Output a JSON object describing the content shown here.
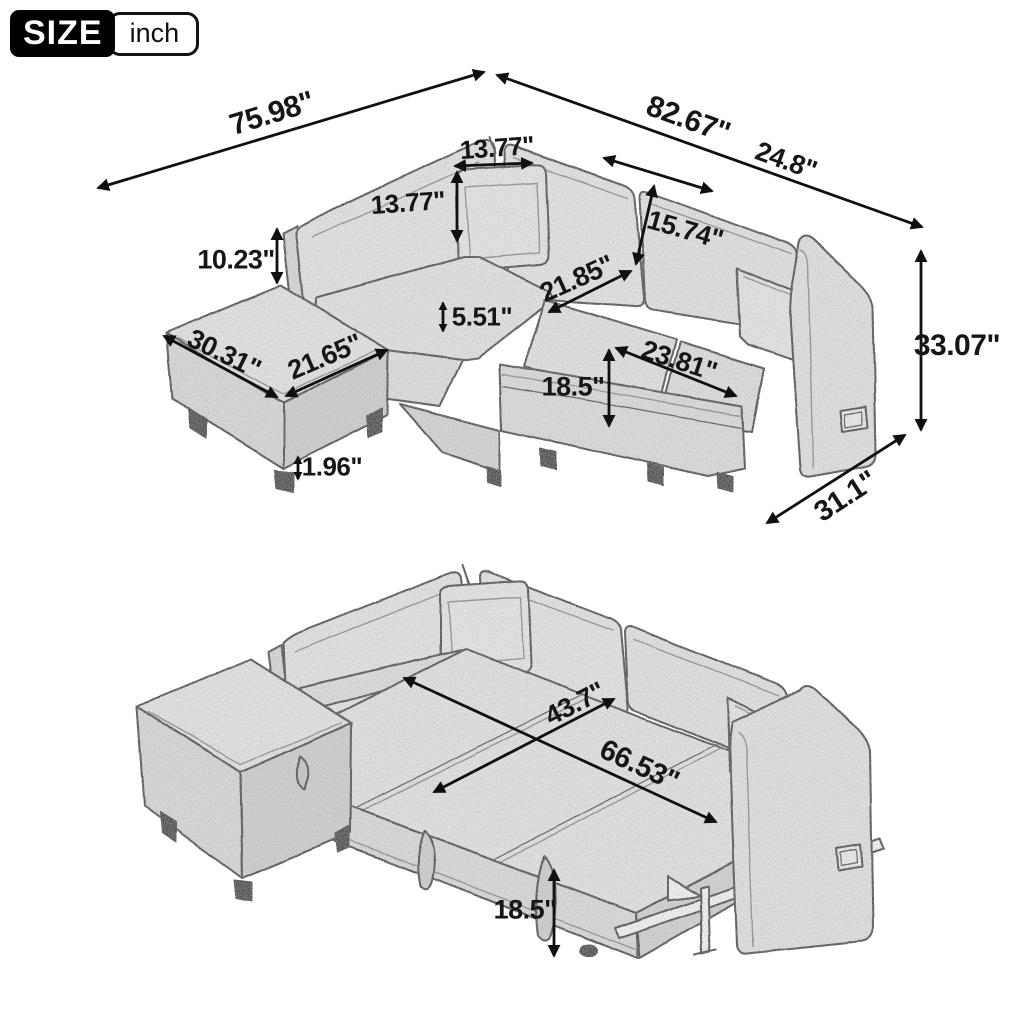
{
  "badge": {
    "label": "SIZE",
    "unit": "inch"
  },
  "units": "inches",
  "top_view": {
    "name": "sectional-sofa-with-ottoman",
    "dims": {
      "overall_width_left": "75.98\"",
      "overall_width_right": "82.67\"",
      "pillow_width": "13.77\"",
      "pillow_height": "13.77\"",
      "back_cushion_width": "24.8\"",
      "back_cushion_height": "15.74\"",
      "backrest_above_seat": "10.23\"",
      "chaise_length": "30.31\"",
      "ottoman_width": "21.65\"",
      "seat_cushion_thickness": "5.51\"",
      "seat_depth": "21.85\"",
      "seat_front_width": "23.81\"",
      "seat_height": "18.5\"",
      "leg_height": "1.96\"",
      "overall_height": "33.07\"",
      "overall_depth": "31.1\""
    }
  },
  "bottom_view": {
    "name": "pull-out-sofa-bed-extended",
    "dims": {
      "bed_width": "43.7\"",
      "bed_length": "66.53\"",
      "bed_height": "18.5\""
    }
  },
  "colors": {
    "ink": "#161616",
    "fabric_light": "#efefef",
    "fabric_mid": "#e3e3e3",
    "fabric_dark": "#d8d8d8",
    "badge_bg": "#000000",
    "badge_text": "#ffffff"
  }
}
